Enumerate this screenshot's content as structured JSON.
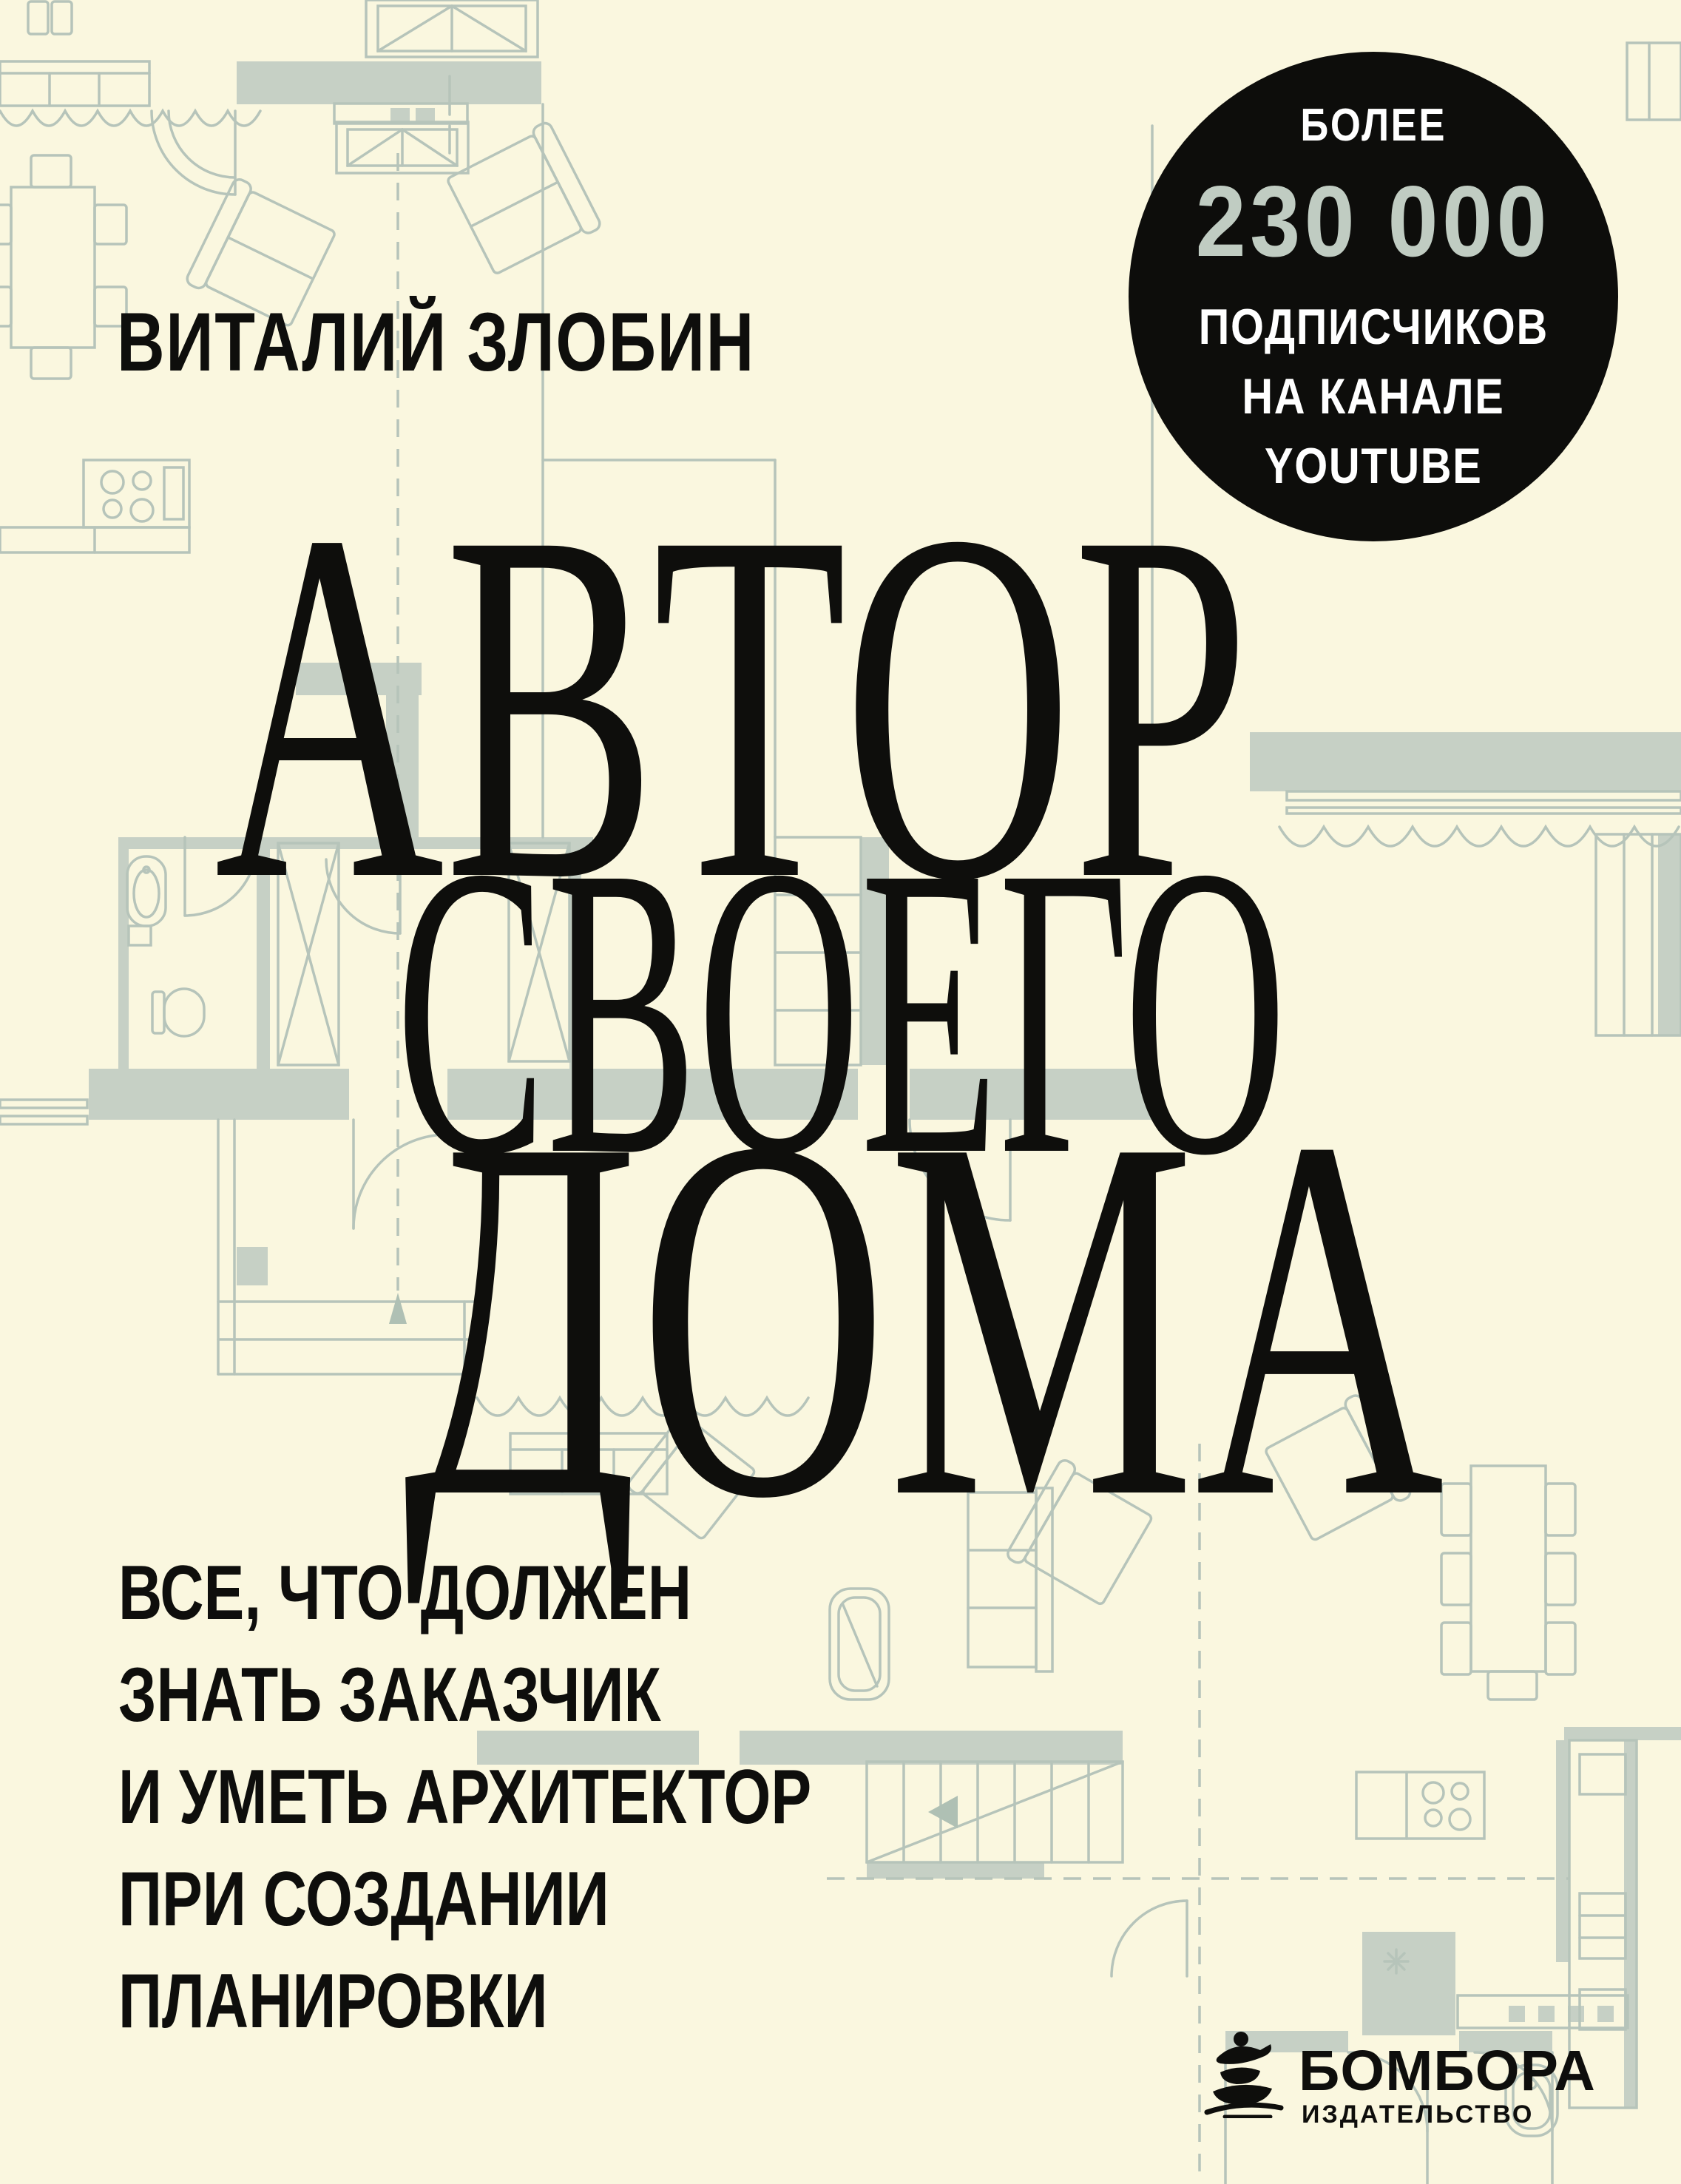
{
  "cover": {
    "author": "ВИТАЛИЙ ЗЛОБИН",
    "badge": {
      "top_line": "БОЛЕЕ",
      "count": "230 000",
      "lines": [
        "ПОДПИСЧИКОВ",
        "НА КАНАЛЕ",
        "YOUTUBE"
      ]
    },
    "title_lines": [
      "АВТОР",
      "СВОЕГО",
      "ДОМА"
    ],
    "subtitle_lines": [
      "ВСЕ, ЧТО ДОЛЖЕН",
      "ЗНАТЬ ЗАКАЗЧИК",
      "И УМЕТЬ АРХИТЕКТОР",
      "ПРИ СОЗДАНИИ",
      "ПЛАНИРОВКИ"
    ],
    "publisher": {
      "name": "БОМБОРА",
      "tagline": "ИЗДАТЕЛЬСТВО"
    },
    "colors": {
      "background": "#FAF7DF",
      "ink": "#0E0E0C",
      "badge_background": "#0D0D0B",
      "badge_accent": "#C0CCC2",
      "plan_line": "#B6C4BA",
      "plan_wall": "#C6D0C5"
    }
  }
}
